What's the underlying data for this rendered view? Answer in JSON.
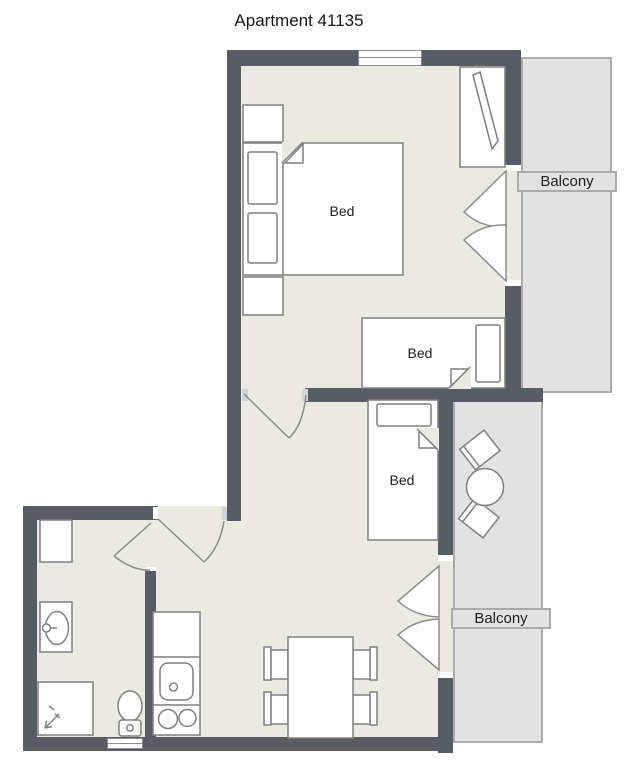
{
  "title": "Apartment 41135",
  "labels": {
    "bed_main": "Bed",
    "bed_small": "Bed",
    "bed_single": "Bed",
    "balcony_top": "Balcony",
    "balcony_bottom": "Balcony"
  },
  "colors": {
    "wall": "#585d64",
    "floor": "#eaeae3",
    "balcony_fill": "#e2e2e2",
    "balcony_border": "#aaaaaa",
    "furniture_outline": "#7f7f7f",
    "background": "#ffffff",
    "text": "#1e1e1e"
  }
}
